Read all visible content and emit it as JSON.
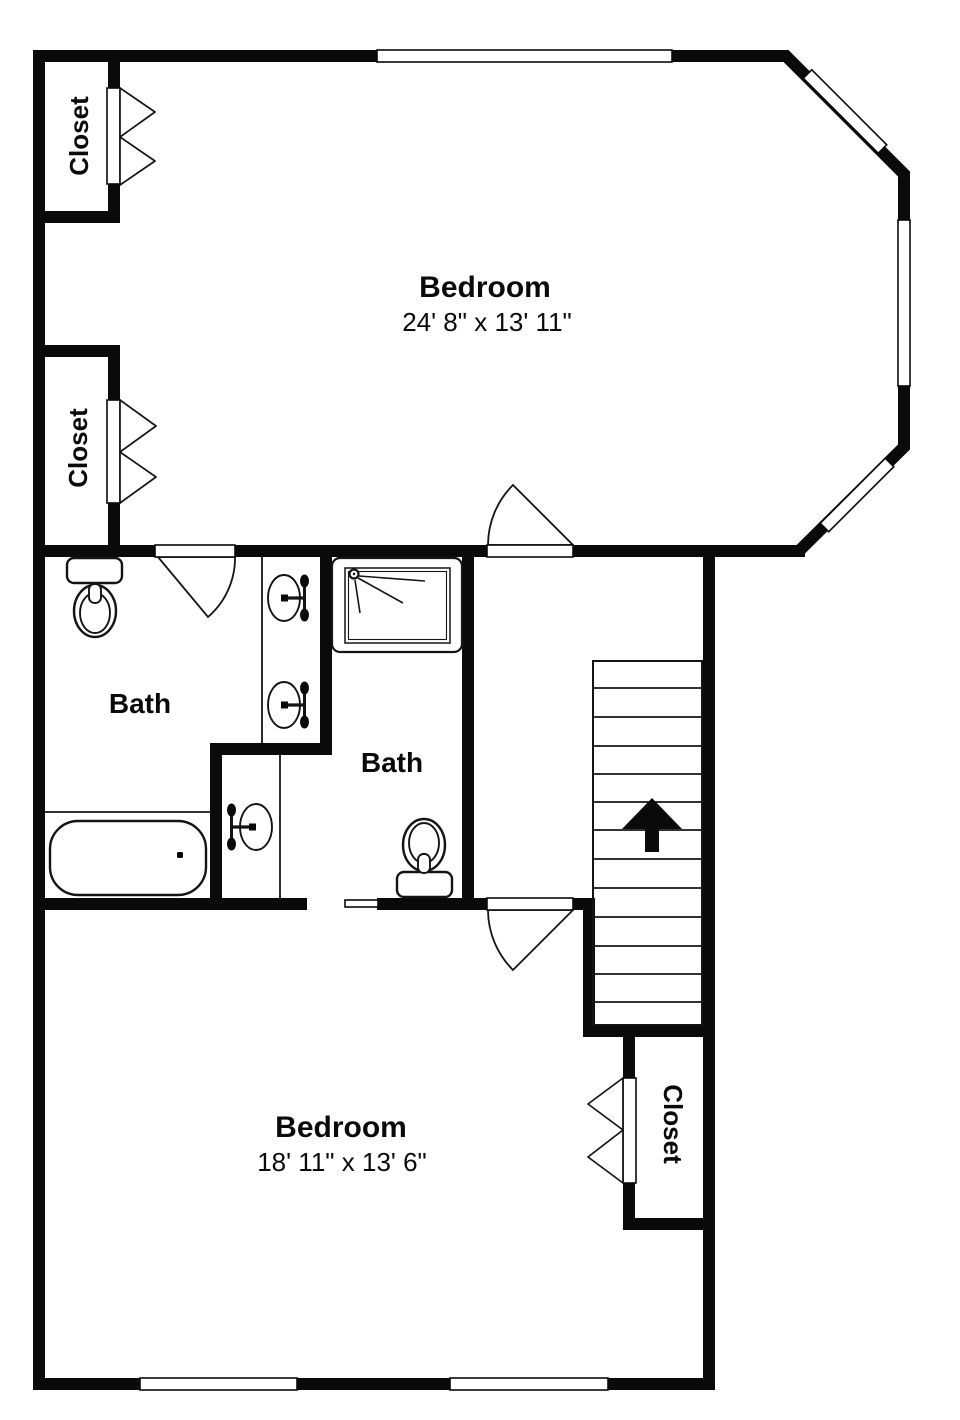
{
  "floor_plan": {
    "rooms": {
      "bedroom_upper": {
        "name": "Bedroom",
        "dimensions": "24' 8\" x 13' 11\""
      },
      "bedroom_lower": {
        "name": "Bedroom",
        "dimensions": "18' 11\" x 13' 6\""
      },
      "bath_left": {
        "name": "Bath"
      },
      "bath_middle": {
        "name": "Bath"
      },
      "closet_upper_left": {
        "name": "Closet"
      },
      "closet_mid_left": {
        "name": "Closet"
      },
      "closet_lower_right": {
        "name": "Closet"
      }
    },
    "stairs": {
      "direction_arrow": "up"
    },
    "colors": {
      "wall": "#0a0a0a",
      "floor": "#ffffff"
    },
    "icons": [
      "toilet-icon",
      "sink-icon",
      "faucet-icon",
      "bathtub-icon",
      "shower-icon",
      "shower-head-icon",
      "bifold-door-icon",
      "door-swing-icon",
      "pocket-door-icon",
      "window-marker",
      "up-arrow-icon"
    ]
  }
}
